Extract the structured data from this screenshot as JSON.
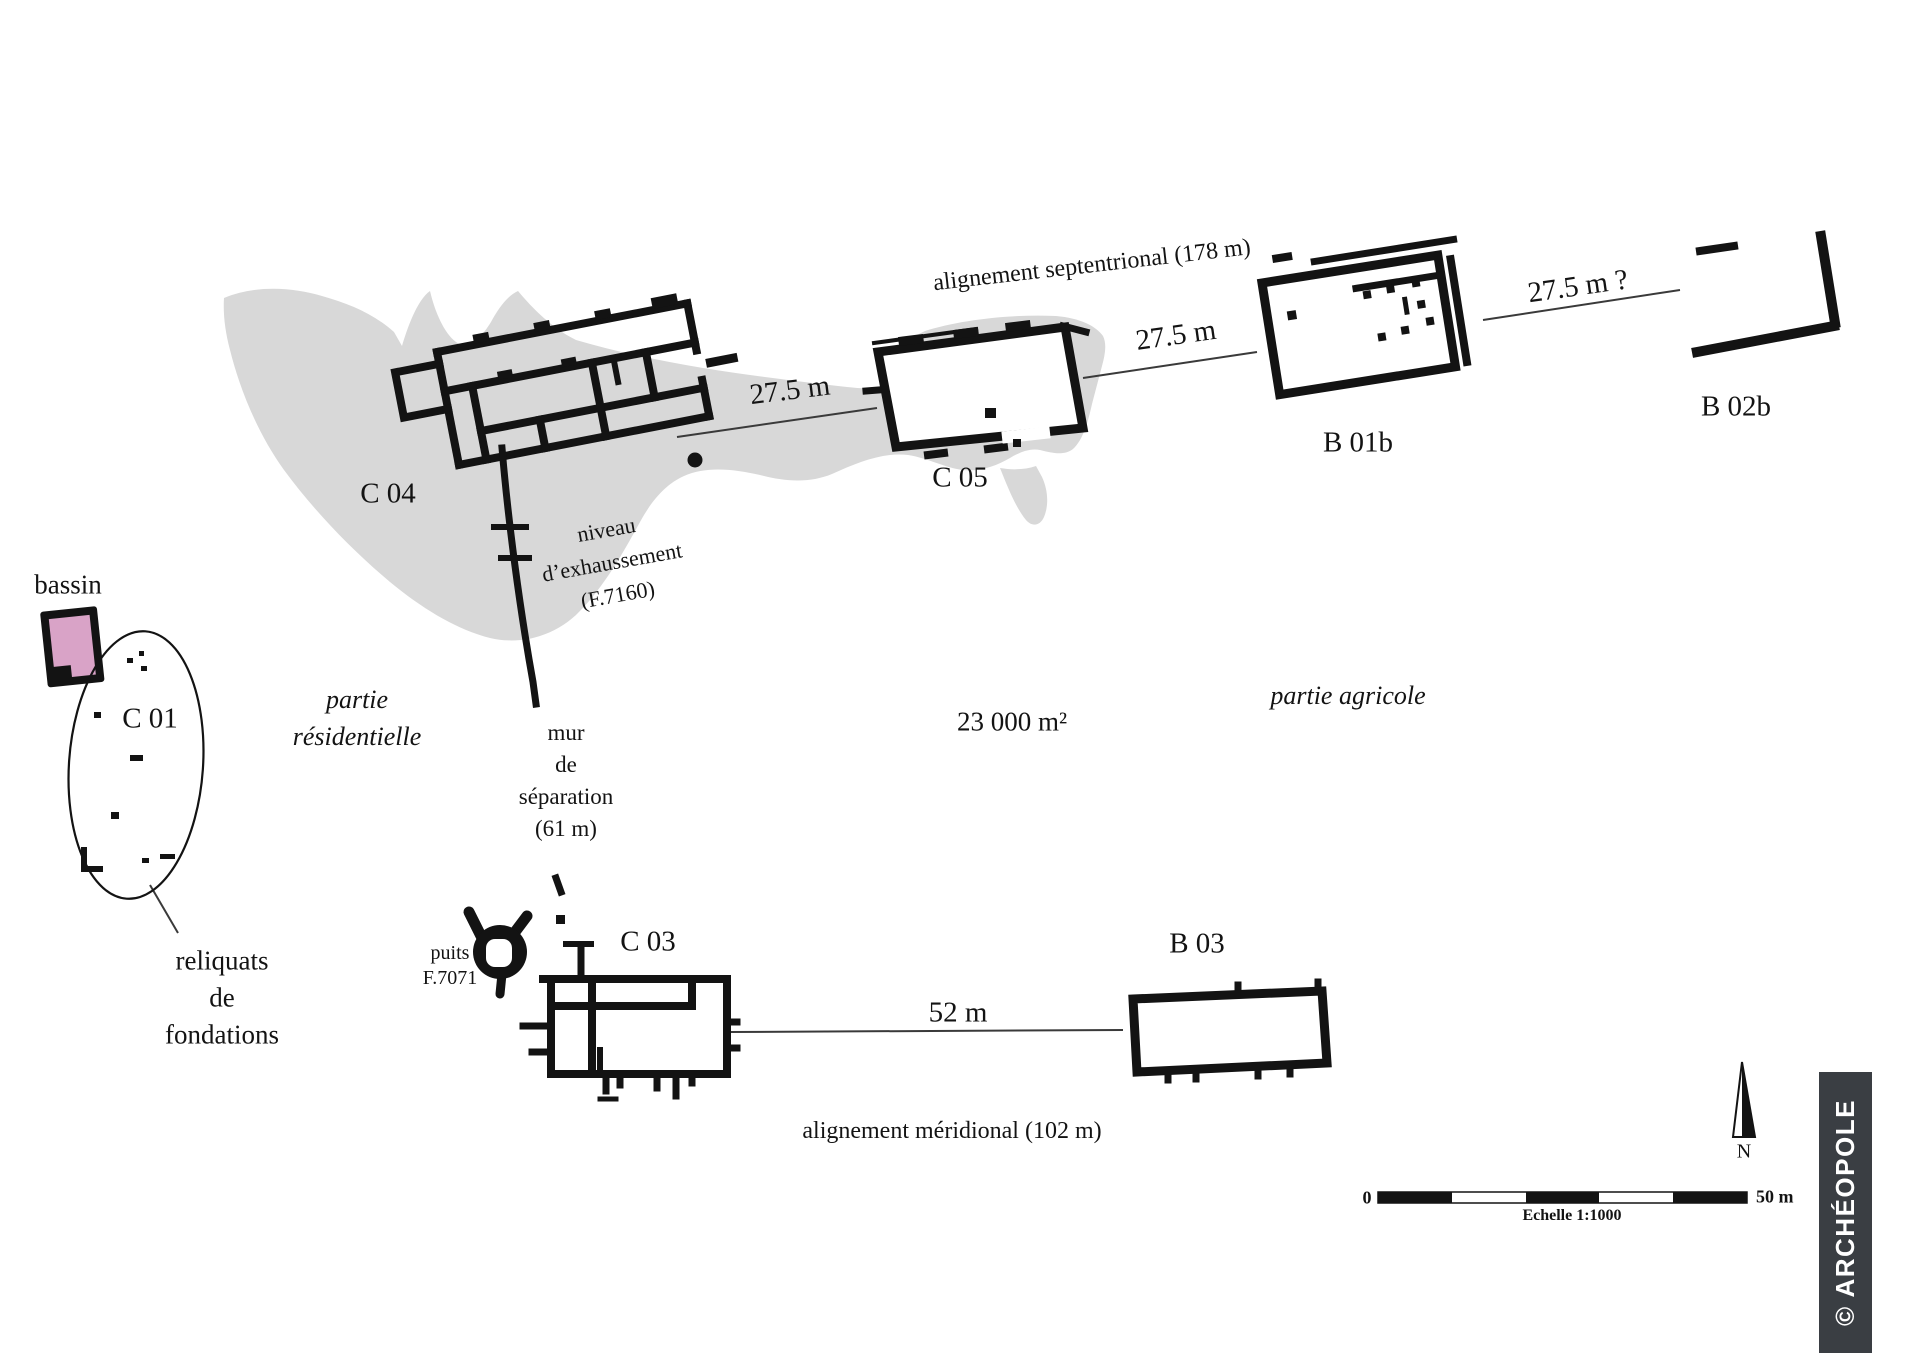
{
  "buildings": {
    "c04": "C 04",
    "c05": "C 05",
    "b01b": "B 01b",
    "b02b": "B 02b",
    "c01": "C 01",
    "c03": "C 03",
    "b03": "B 03"
  },
  "alignments": {
    "north": "alignement septentrional (178 m)",
    "south": "alignement méridional (102 m)"
  },
  "distances": {
    "c04_c05": "27.5 m",
    "c05_b01b": "27.5 m",
    "b01b_b02b": "27.5 m ?",
    "c03_b03": "52 m"
  },
  "area_label": "23 000 m²",
  "zones": {
    "residential": "partie\nrésidentielle",
    "agricultural": "partie agricole"
  },
  "features": {
    "basin": "bassin",
    "well": "puits\nF.7071",
    "separation_wall": "mur\nde\nséparation\n(61 m)",
    "raising_level": "niveau\nd’exhaussement\n(F.7160)",
    "foundation_remnants": "reliquats\nde\nfondations"
  },
  "scale_bar": {
    "start": "0",
    "end": "50 m",
    "caption": "Echelle 1:1000"
  },
  "compass": {
    "north": "N"
  },
  "watermark": "© ARCHÉOPOLE",
  "colors": {
    "wall": "#131313",
    "zone_fill": "#d8d8d8",
    "basin_fill": "#d9a3c7",
    "watermark_bg": "#3a3e43",
    "line": "#3a3a3a"
  }
}
